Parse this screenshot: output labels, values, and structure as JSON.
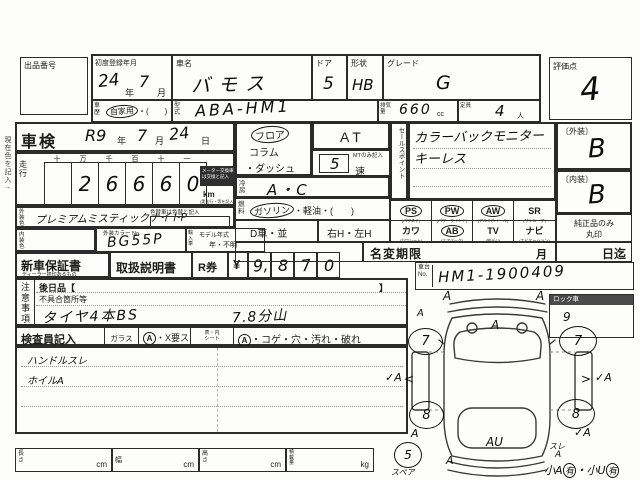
{
  "margin": {
    "note": "現在色を記入→"
  },
  "top": {
    "auction_no": "出品番号",
    "first_reg": "初度登録年月",
    "reg_year": "24",
    "nen": "年",
    "reg_month": "7",
    "tsuki": "月",
    "car_name_label": "車名",
    "car_name": "バモス",
    "door_label": "ドア",
    "door": "5",
    "shape_label": "形状",
    "shape": "HB",
    "grade_label": "グレード",
    "grade": "G",
    "score_label": "評価点",
    "score": "4",
    "history_label": "車歴",
    "history": "自家用",
    "history_paren": "・(　　)",
    "model_label": "型式",
    "model": "ABA-HM1",
    "disp_label": "排気量",
    "disp": "660",
    "cc": "cc",
    "cap_label": "定員",
    "cap": "4",
    "nin": "人"
  },
  "shaken": {
    "label": "車検",
    "v1": "R9",
    "nen": "年",
    "v2": "7",
    "tsuki": "月",
    "v3": "24",
    "hi": "日"
  },
  "run": {
    "label": "走行",
    "h": [
      "十",
      "万",
      "千",
      "百",
      "十",
      "一"
    ],
    "d": [
      "",
      "2",
      "6",
      "6",
      "6",
      "0"
    ],
    "km": "km",
    "note": "(実走行・等を記入)",
    "badge1": "メーター交換車",
    "badge2": "は交換と記入"
  },
  "ext": {
    "label": "外装色",
    "value": "プレミアムミスティックナイトP",
    "note": "色替車は色替と記入"
  },
  "intc": {
    "label": "内装色",
    "no_label": "外装カラー No.",
    "no": "BG55P",
    "import_label": "輸入車",
    "my": "モデル年式",
    "year": "年・不明"
  },
  "shift": {
    "o1": "フロア",
    "o2": "コラム",
    "o3": "・ダッシュ",
    "at": "AT",
    "mt": "MTのみ記入",
    "g": "5",
    "soku": "速"
  },
  "ac": {
    "label": "冷房",
    "v": "A・C"
  },
  "fuel": {
    "label": "燃料",
    "gas": "ガソリン",
    "rest": "・軽油・(　　)"
  },
  "dc": {
    "d": "D車・並",
    "h": "右H・左H"
  },
  "sales": {
    "label": "セールスポイント",
    "l1": "カラーバックモニター",
    "l2": "キーレス"
  },
  "equipment": {
    "cells": [
      {
        "code": "PS",
        "name": "(パワステ)",
        "circled": true
      },
      {
        "code": "PW",
        "name": "(パワーウインド)",
        "circled": true
      },
      {
        "code": "AW",
        "name": "(アルミホイール)",
        "circled": true
      },
      {
        "code": "SR",
        "name": "(サンルーフ)",
        "circled": false
      },
      {
        "code": "カワ",
        "name": "(カワシート)",
        "circled": false
      },
      {
        "code": "AB",
        "name": "(エアバッグ)",
        "circled": true
      },
      {
        "code": "TV",
        "name": "(地デジ)",
        "circled": false
      },
      {
        "code": "ナビ",
        "name": "(ナビゲーション)",
        "circled": false
      }
    ]
  },
  "rate": {
    "ext_l": "〔外装〕",
    "ext": "B",
    "int_l": "〔内装〕",
    "int": "B",
    "gen1": "純正品のみ",
    "gen2": "丸印"
  },
  "nc": {
    "label": "名変期限",
    "m": "月",
    "until": "日迄"
  },
  "docs": {
    "w": "新車保証書",
    "wn": "ディーラー捺印あるもの",
    "m": "取扱説明書",
    "r": "R券",
    "yen": "¥",
    "d1": "9,",
    "d2": "8",
    "d3": "7",
    "d4": "0"
  },
  "chassis": {
    "l1": "車台",
    "l2": "No.",
    "v": "HM1-1900409"
  },
  "notes": {
    "label": "注意事項",
    "l1": "後日品【",
    "br": "】",
    "l2": "不具合箇所等",
    "h1": "タイヤ4本BS",
    "h2": "7.8分山"
  },
  "insp": {
    "label": "検査員記入",
    "glass": "ガラス",
    "a": "A",
    "x": "・X要ス",
    "s1": "表・内",
    "s2": "シート",
    "a2": "A",
    "rest": "・コゲ・穴・汚れ・破れ",
    "h1": "ハンドルスレ",
    "h2": "ホイルA"
  },
  "dims": {
    "l": "長さ",
    "w": "幅",
    "h": "高さ",
    "ld": "積載量",
    "cm": "cm",
    "kg": "kg"
  },
  "diagram": {
    "lock": "ロック車",
    "wfl": "7",
    "wfr": "7",
    "wrl": "8",
    "wrr": "8",
    "spare_mark": "5",
    "spare": "スペア",
    "m_fl": "A",
    "m_fr": "A",
    "m_lf": "A",
    "m_rf": "9",
    "m_hood": "A",
    "m_ls": "✓A",
    "m_la": "<",
    "m_ra": ">",
    "m_rs": "✓A",
    "m_ll": "A",
    "m_rl": "✓A",
    "m_rc": "AU",
    "m_rb": "A",
    "m_sure": "スレ",
    "m_sa": "A",
    "n1": "小A",
    "n2": "有",
    "n3": "・小U",
    "n4": "有"
  }
}
